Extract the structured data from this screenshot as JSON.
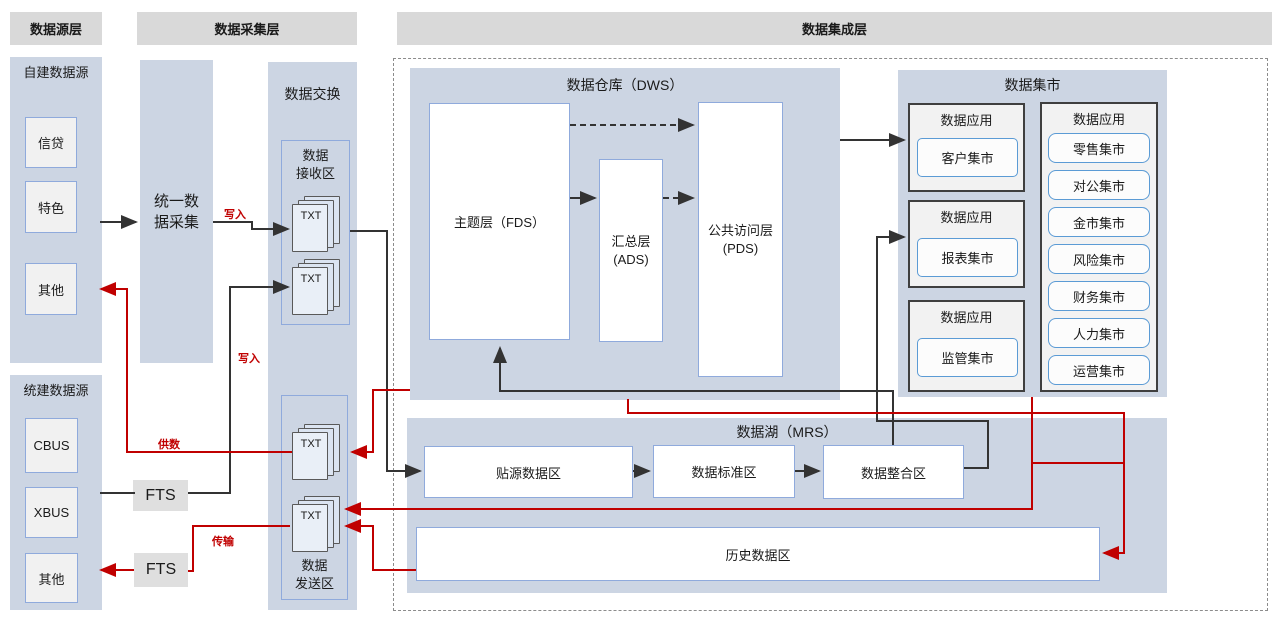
{
  "headers": {
    "source": "数据源层",
    "collect": "数据采集层",
    "integration": "数据集成层"
  },
  "source_self": {
    "title": "自建数据源",
    "box1": "信贷",
    "box2": "特色",
    "box3": "其他"
  },
  "source_unified": {
    "title": "统建数据源",
    "box1": "CBUS",
    "box2": "XBUS",
    "box3": "其他"
  },
  "collect": {
    "label_line1": "统一数",
    "label_line2": "据采集"
  },
  "fts": {
    "label": "FTS"
  },
  "exchange": {
    "title": "数据交换",
    "recv_line1": "数据",
    "recv_line2": "接收区",
    "send_line1": "数据",
    "send_line2": "发送区",
    "txt": "TXT"
  },
  "dws": {
    "title": "数据仓库（DWS）",
    "fds": "主题层（FDS）",
    "ads_line1": "汇总层",
    "ads_line2": "(ADS)",
    "pds_line1": "公共访问层",
    "pds_line2": "(PDS)"
  },
  "mart": {
    "title": "数据集市",
    "app": "数据应用",
    "inner1": "客户集市",
    "inner2": "报表集市",
    "inner3": "监管集市",
    "list": [
      "零售集市",
      "对公集市",
      "金市集市",
      "风险集市",
      "财务集市",
      "人力集市",
      "运营集市"
    ]
  },
  "mrs": {
    "title": "数据湖（MRS）",
    "box1": "贴源数据区",
    "box2": "数据标准区",
    "box3": "数据整合区",
    "history": "历史数据区"
  },
  "flow": {
    "write_top": "写入",
    "write_mid": "写入",
    "supply": "供数",
    "transfer": "传输"
  },
  "colors": {
    "region_fill": "#ccd5e3",
    "header_fill": "#d9d9d9",
    "line_black": "#333333",
    "line_red": "#c00000",
    "border_blue": "#8faadc",
    "border_dark": "#3f3f3f"
  }
}
